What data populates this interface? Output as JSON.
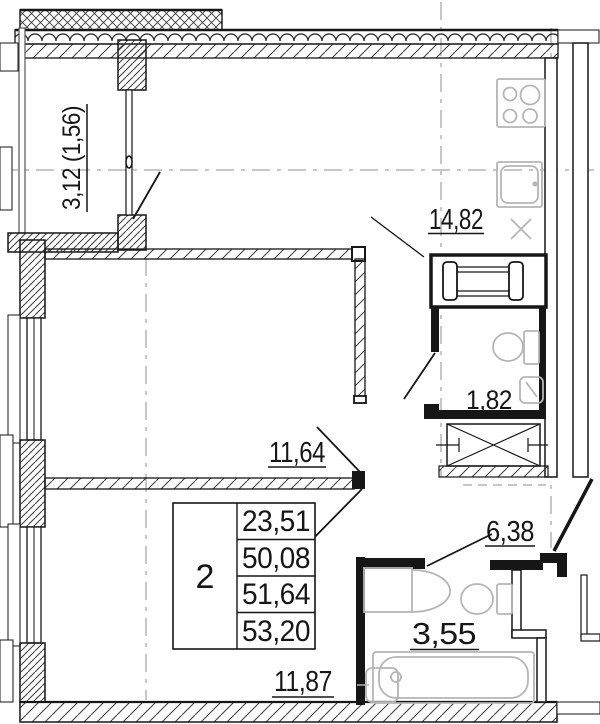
{
  "drawing": {
    "type": "apartment-floor-plan",
    "unit_table": {
      "rooms_count": "2",
      "areas": [
        "23,51",
        "50,08",
        "51,64",
        "53,20"
      ]
    },
    "rooms": {
      "balcony": {
        "label": "3,12 (1,56)"
      },
      "kitchen_living": {
        "label": "14,82"
      },
      "wc": {
        "label": "1,82"
      },
      "room1": {
        "label": "11,64"
      },
      "hall": {
        "label": "6,38"
      },
      "bathroom": {
        "label": "3,55"
      },
      "room2": {
        "label": "11,87"
      }
    },
    "colors": {
      "line": "#161616",
      "fixture": "#b5b5b5",
      "axis": "#8f8f8f",
      "background": "#ffffff"
    }
  }
}
